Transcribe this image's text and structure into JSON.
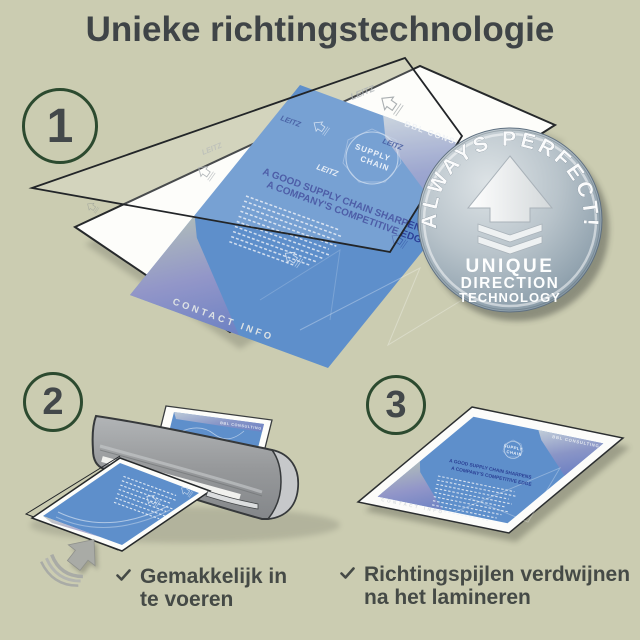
{
  "title": "Unieke richtingstechnologie",
  "steps": [
    {
      "number": "1"
    },
    {
      "number": "2"
    },
    {
      "number": "3"
    }
  ],
  "badge": {
    "arc_text": "ALWAYS PERFECT!",
    "line1": "UNIQUE",
    "line2": "DIRECTION",
    "line3": "TECHNOLOGY"
  },
  "brochure": {
    "brand": "LEITZ",
    "header": "BBL CONSULTING",
    "emblem_top": "SUPPLY",
    "emblem_bottom": "CHAIN",
    "headline1": "A GOOD SUPPLY CHAIN SHARPENS",
    "headline2": "A COMPANY'S COMPETITIVE EDGE",
    "footer": "CONTACT INFO"
  },
  "checklist": [
    {
      "line1": "Gemakkelijk in",
      "line2": "te voeren"
    },
    {
      "line1": "Richtingspijlen verdwijnen",
      "line2": "na het lamineren"
    }
  ],
  "colors": {
    "background": "#cbccb1",
    "heading_text": "#3f4447",
    "step_circle_green": "#2c4a2f",
    "document_blue": "#5e8fcb",
    "badge_silver": "#a8b6c0",
    "badge_text": "#ffffff",
    "arrow_gray": "#a9aba6"
  }
}
